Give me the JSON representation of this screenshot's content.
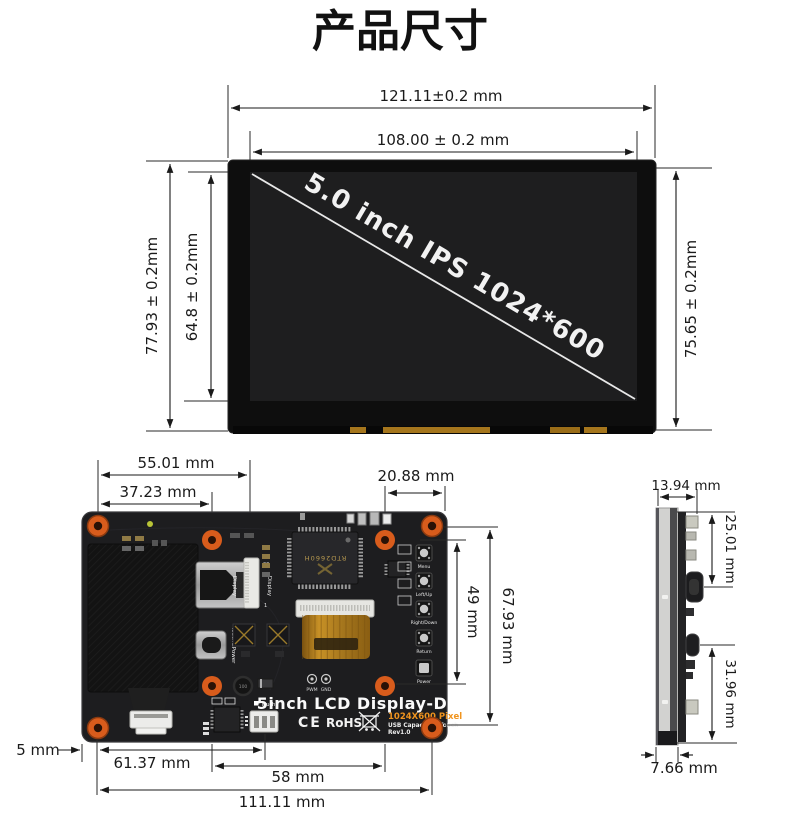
{
  "title": "产品尺寸",
  "front": {
    "screen_label": "5.0 inch IPS 1024*600",
    "dim_outer_width": "121.11±0.2 mm",
    "dim_active_width": "108.00 ± 0.2 mm",
    "dim_outer_height": "77.93 ± 0.2mm",
    "dim_active_height": "64.8 ± 0.2mm",
    "dim_glass_height": "75.65 ± 0.2mm"
  },
  "board": {
    "dim_top_hole_span": "55.01 mm",
    "dim_top_hole_pitch": "37.23 mm",
    "dim_top_right": "20.88 mm",
    "dim_button_span": "49 mm",
    "dim_right_hole_span": "67.93 mm",
    "dim_edge_to_hole": "5 mm",
    "dim_edge_to_touch": "61.37 mm",
    "dim_bottom_hole_pitch": "58 mm",
    "dim_bottom_hole_span": "111.11 mm",
    "silk": {
      "hdmi": "Display",
      "fpc": "Display",
      "fpc_pin_last": "20",
      "fpc_pin_first": "1",
      "usb": "Touch&Power",
      "buttons": [
        "Menu",
        "Left/Up",
        "Right/Down",
        "Return",
        "Power"
      ],
      "pwm": "PWM",
      "gnd": "GND",
      "touch": "Touch",
      "product": "5inch LCD Display-D",
      "resolution": "1024X600 Pixel",
      "touch_type": "USB Capacitive Touch",
      "revision": "Rev1.0",
      "ce": "CE",
      "rohs": "RoHS",
      "chip": "RTD2660H",
      "inductor": "100"
    }
  },
  "side": {
    "dim_total_thickness": "13.94 mm",
    "dim_top_to_hdmi": "25.01 mm",
    "dim_usb_to_bottom": "31.96 mm",
    "dim_panel_thickness": "7.66 mm"
  },
  "colors": {
    "hole_orange": "#d85c1c",
    "silk_orange": "#f0941e",
    "ribbon_gold": "#b8860b",
    "screen_black": "#0e0e0e",
    "pcb_black": "#1d1d1f"
  }
}
